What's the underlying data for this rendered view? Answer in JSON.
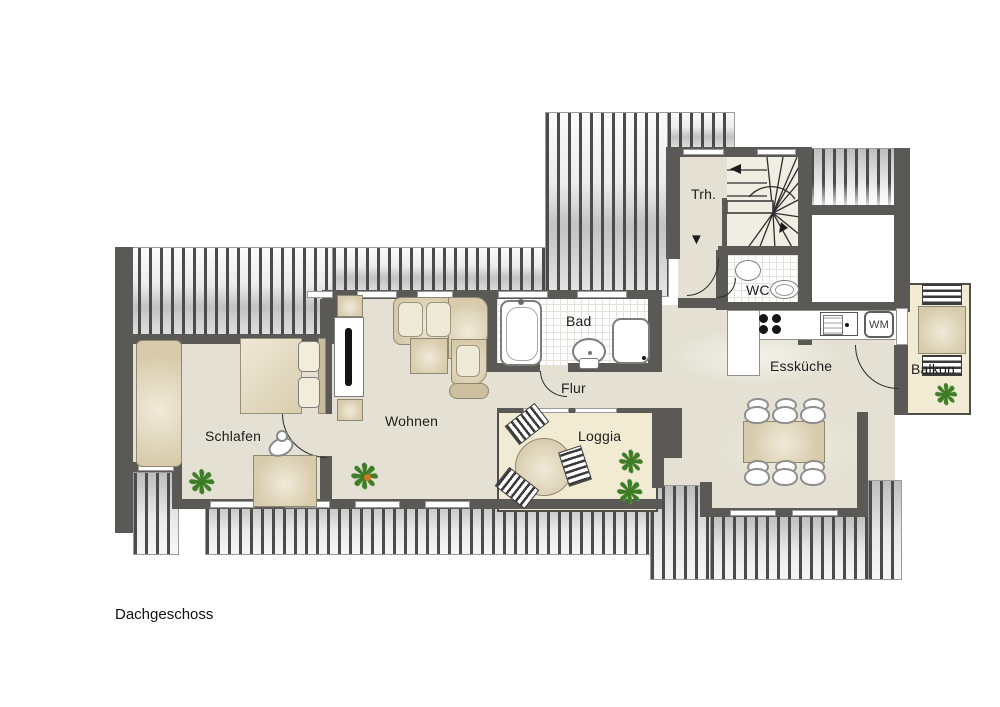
{
  "meta": {
    "plan_title": "Dachgeschoss"
  },
  "rooms": {
    "schlafen": "Schlafen",
    "wohnen": "Wohnen",
    "bad": "Bad",
    "flur": "Flur",
    "loggia": "Loggia",
    "esskueche": "Essküche",
    "wc": "WC",
    "treppenhaus": "Trh.",
    "balkon": "Balkon"
  },
  "appliances": {
    "washing_machine": "WM"
  },
  "symbols": {
    "plant": "❋",
    "entrance_arrow": "▼"
  },
  "colors": {
    "wall": "#5a5955",
    "floor": "#e4e1d4",
    "outdoor": "#f1ebd3",
    "stripe": "#4b4b4b",
    "furn": "#d8cbab",
    "plant": "#3c7d26",
    "text": "#1d1d1d"
  }
}
